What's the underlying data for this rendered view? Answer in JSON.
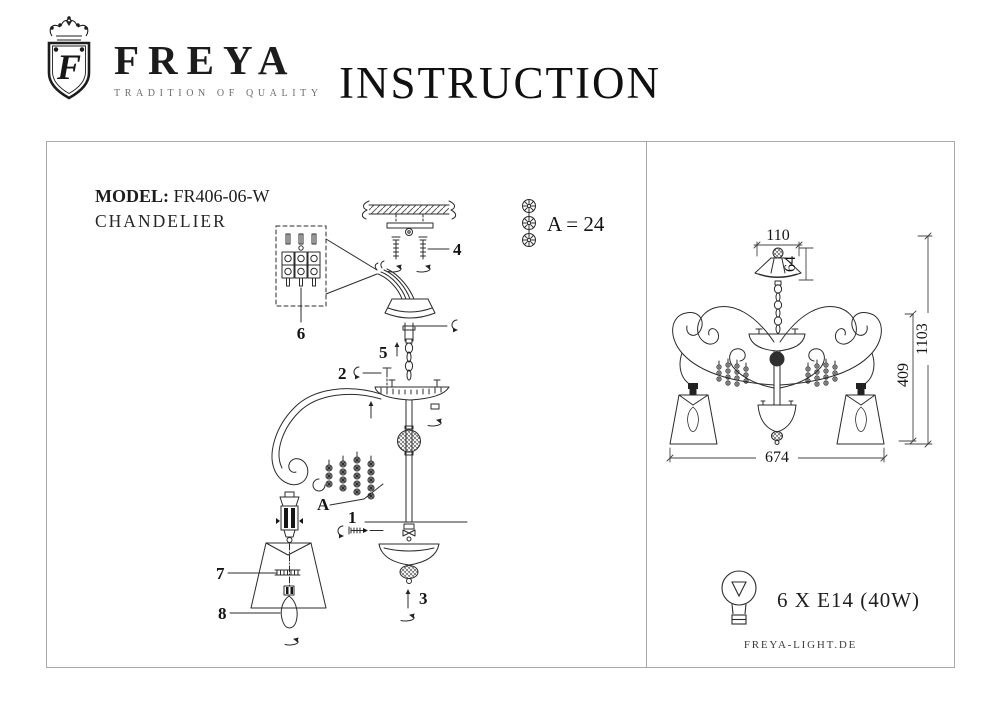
{
  "brand": {
    "name": "FREYA",
    "tagline": "TRADITION OF QUALITY",
    "crest_letter": "F"
  },
  "title": "INSTRUCTION",
  "product": {
    "model_label": "MODEL:",
    "model_value": "FR406-06-W",
    "type": "CHANDELIER"
  },
  "exploded": {
    "crystal_note": "A = 24",
    "labels": {
      "p1": "1",
      "p2": "2",
      "p3": "3",
      "p4": "4",
      "p5": "5",
      "p6": "6",
      "p7": "7",
      "p8": "8",
      "beads": "A"
    }
  },
  "dimensions": {
    "canopy_width": "110",
    "canopy_height": "64",
    "fixture_height": "409",
    "total_height": "1103",
    "fixture_width": "674"
  },
  "spec": {
    "bulbs": "6 X E14 (40W)"
  },
  "footer": {
    "website": "FREYA-LIGHT.DE"
  }
}
